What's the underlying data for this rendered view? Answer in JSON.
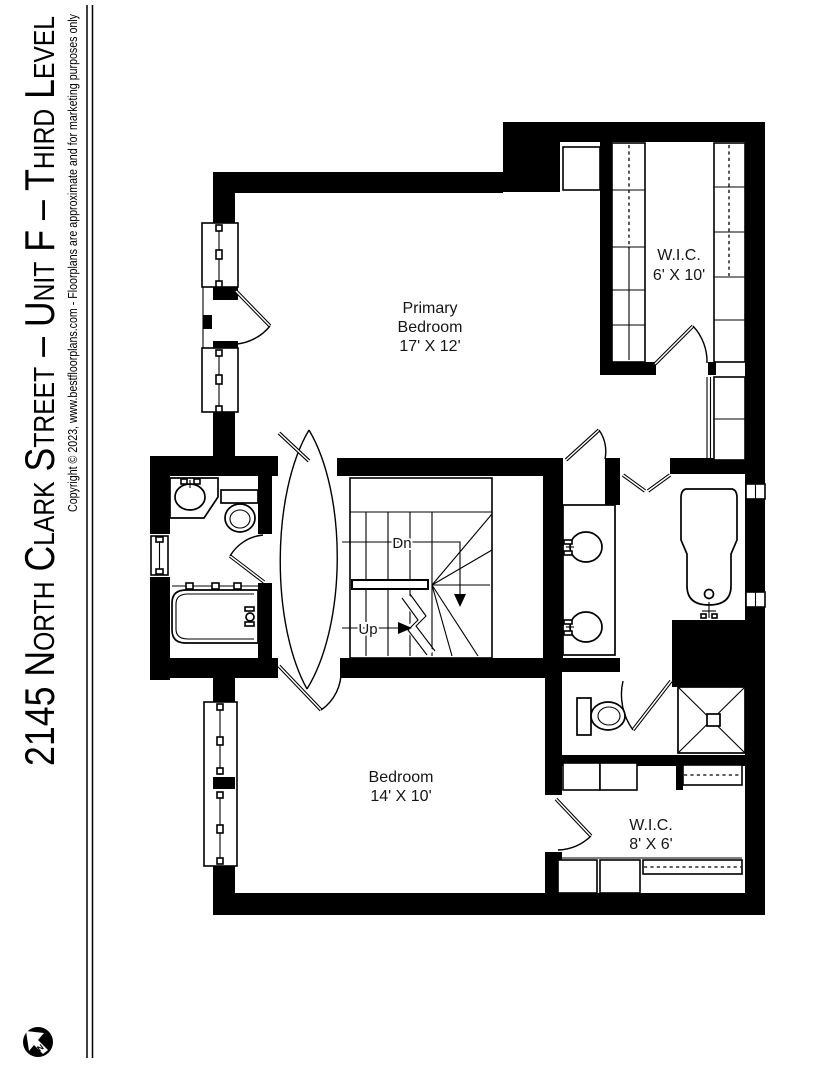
{
  "document": {
    "title": "2145 North Clark Street – Unit F – Third Level",
    "copyright": "Copyright © 2023, www.bestfloorplans.com - Floorplans are approximate and for marketing purposes only"
  },
  "compass": {
    "label": "N"
  },
  "rooms": {
    "primary_bedroom": {
      "line1": "Primary",
      "line2": "Bedroom",
      "dims": "17' X 12'"
    },
    "wic_upper": {
      "label": "W.I.C.",
      "dims": "6' X 10'"
    },
    "bedroom": {
      "label": "Bedroom",
      "dims": "14' X 10'"
    },
    "wic_lower": {
      "label": "W.I.C.",
      "dims": "8' X 6'"
    }
  },
  "stairs": {
    "down": "Dn",
    "up": "Up"
  },
  "colors": {
    "ink": "#000000",
    "paper": "#ffffff"
  }
}
